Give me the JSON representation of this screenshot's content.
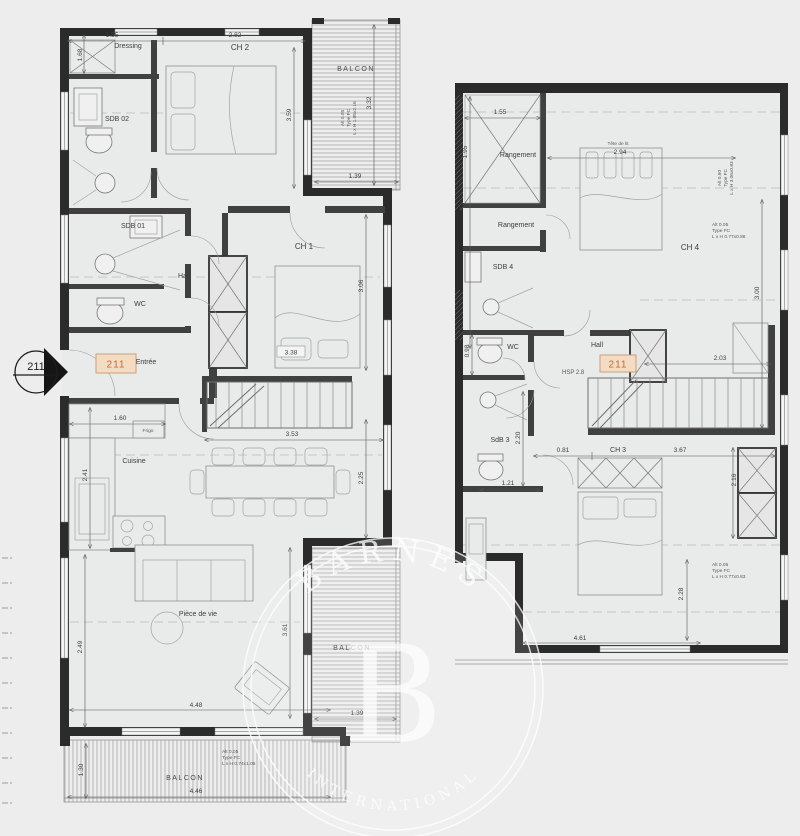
{
  "canvas": {
    "background": "#ecedec"
  },
  "watermark": {
    "brand": "BARNES",
    "monogram": "B",
    "sub": "INTERNATIONAL"
  },
  "entrance_marker": {
    "label": "211"
  },
  "floor1": {
    "tag": "211",
    "rooms": {
      "dressing": "Dressing",
      "ch2": "CH 2",
      "sdb02": "SDB 02",
      "sdb01": "SDB 01",
      "hall": "Hall",
      "wc": "WC",
      "ch1": "CH 1",
      "entree": "Entrée",
      "cuisine": "Cuisine",
      "piece_de_vie": "Pièce de vie",
      "balcon_top": "BALCON",
      "balcon_side": "BALCON",
      "balcon_bottom": "BALCON"
    },
    "labels": {
      "frigo": "Frigo"
    },
    "dims": {
      "top_left": "1.55",
      "top_right": "2.82",
      "left_top": "1.68",
      "ch2_height": "3.59",
      "balcon_top_width": "1.39",
      "balcon_top_height": "3.32",
      "ch1_bed": "3.38",
      "ch1_height": "3.06",
      "stairs_width": "3.53",
      "cuisine_width": "1.60",
      "cuisine_height": "2.41",
      "dining_height": "2.25",
      "sejour_left": "2.49",
      "sejour_height": "3.61",
      "sejour_width": "4.48",
      "balcon_side_width": "1.39",
      "balcon_bottom_height": "1.30",
      "balcon_bottom_width": "4.46"
    },
    "notes": {
      "balcon_top": {
        "l1": "Alt 0.05",
        "l2": "Type FC",
        "l3": "L x H 1.05x2.16"
      },
      "balcon_bottom": {
        "l1": "Alt   0.05",
        "l2": "Type FC",
        "l3": "L x H 0.74x1.05"
      }
    }
  },
  "floor2": {
    "tag": "211",
    "hsp": "HSP 2.8",
    "rooms": {
      "rangement_1": "Rangement",
      "rangement_2": "Rangement",
      "sdb4": "SDB 4",
      "wc": "WC",
      "hall": "Hall",
      "ch4": "CH 4",
      "sdb3": "SdB 3",
      "ch3": "CH 3"
    },
    "labels": {
      "tete_de_lit": "Tête de lit"
    },
    "dims": {
      "top_left": "1.55",
      "left_height": "1.95",
      "bed_width": "2.94",
      "wc_height": "0.98",
      "ch4_height": "3.00",
      "hall_width": "2.03",
      "sdb3_height": "2.20",
      "sdb3_width": "1.21",
      "stair_start": "0.81",
      "ch3_width": "3.67",
      "ch3_bottom": "4.61",
      "closet_height": "2.16",
      "window_height": "2.28"
    },
    "notes": {
      "ch4_right": {
        "l1": "Alt 0.90",
        "l2": "Type FC",
        "l3": "L x H 3.06x0.83"
      },
      "ch4_window": {
        "l1": "Alt   0.05",
        "l2": "Type FC",
        "l3": "L x H 0.77x0.88"
      },
      "ch3_window": {
        "l1": "Alt   0.05",
        "l2": "Type FC",
        "l3": "L x H 0.77x0.83"
      }
    }
  }
}
